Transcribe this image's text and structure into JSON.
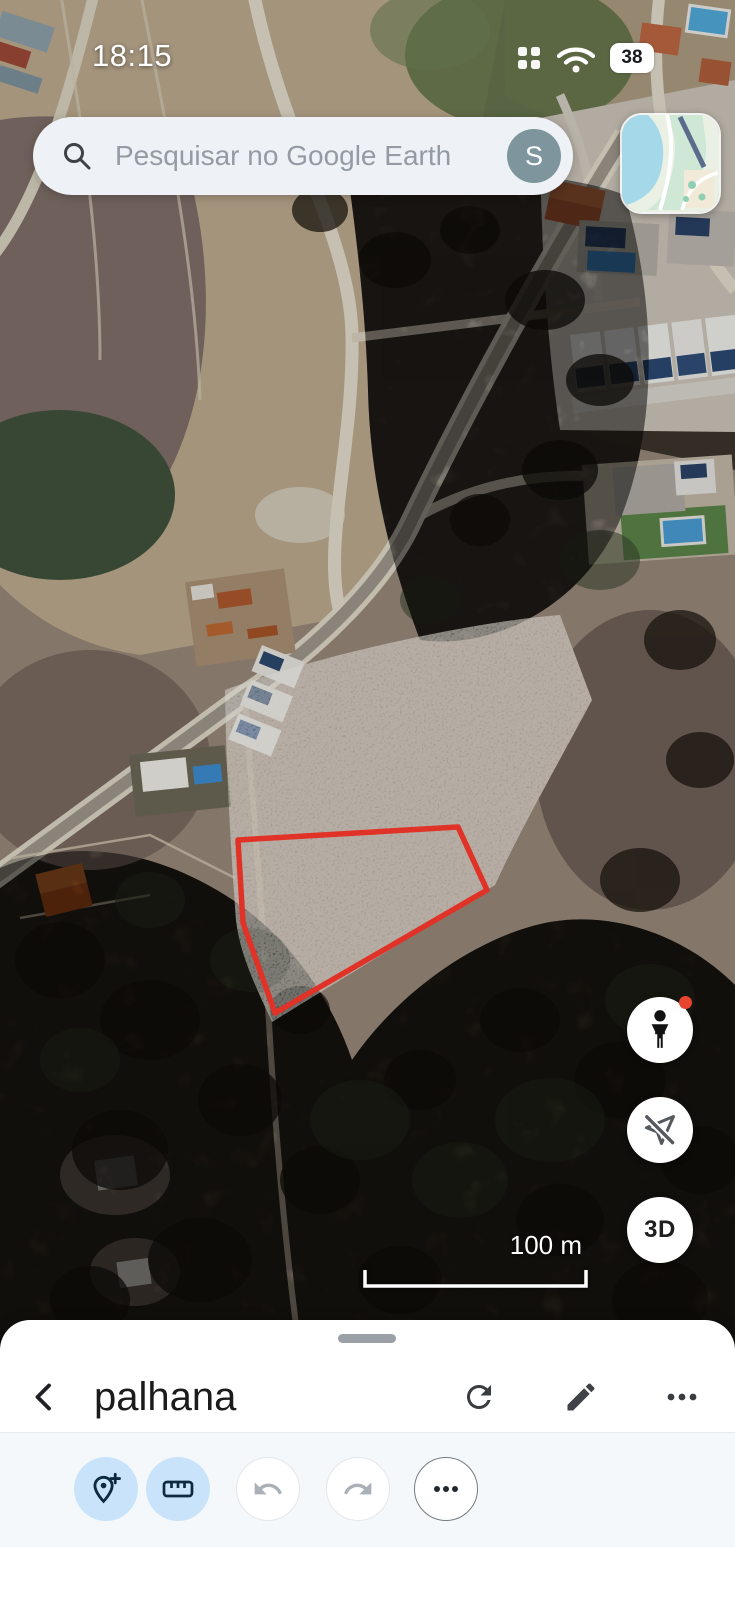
{
  "status_bar": {
    "time": "18:15",
    "battery_level": "38"
  },
  "search_bar": {
    "placeholder": "Pesquisar no Google Earth",
    "account_initial": "S"
  },
  "map_controls": {
    "three_d_label": "3D",
    "scale_label": "100 m"
  },
  "bottom_sheet": {
    "title": "palhana"
  },
  "colors": {
    "toolbar_active_bg": "#c9e4fa",
    "selection_polygon_red": "#e03226",
    "pegman_alert_dot": "#e8442e",
    "avatar_bg": "#7e959d",
    "sheet_toolbar_bg": "#f5f8fb"
  },
  "icons": {
    "search": "magnifier",
    "status_grid": "2x2 dot grid",
    "wifi": "wifi arcs",
    "battery": "white pill with percent",
    "map_thumbnail": "map style preview",
    "pegman": "street-view person",
    "navigation_off": "location arrow with slash",
    "back": "chevron left",
    "refresh": "circular arrow",
    "edit": "pencil",
    "more": "three dots",
    "add_pin": "location pin with plus",
    "measure": "ruler",
    "undo": "curved arrow left",
    "redo": "curved arrow right",
    "overflow": "three dots in circle"
  }
}
